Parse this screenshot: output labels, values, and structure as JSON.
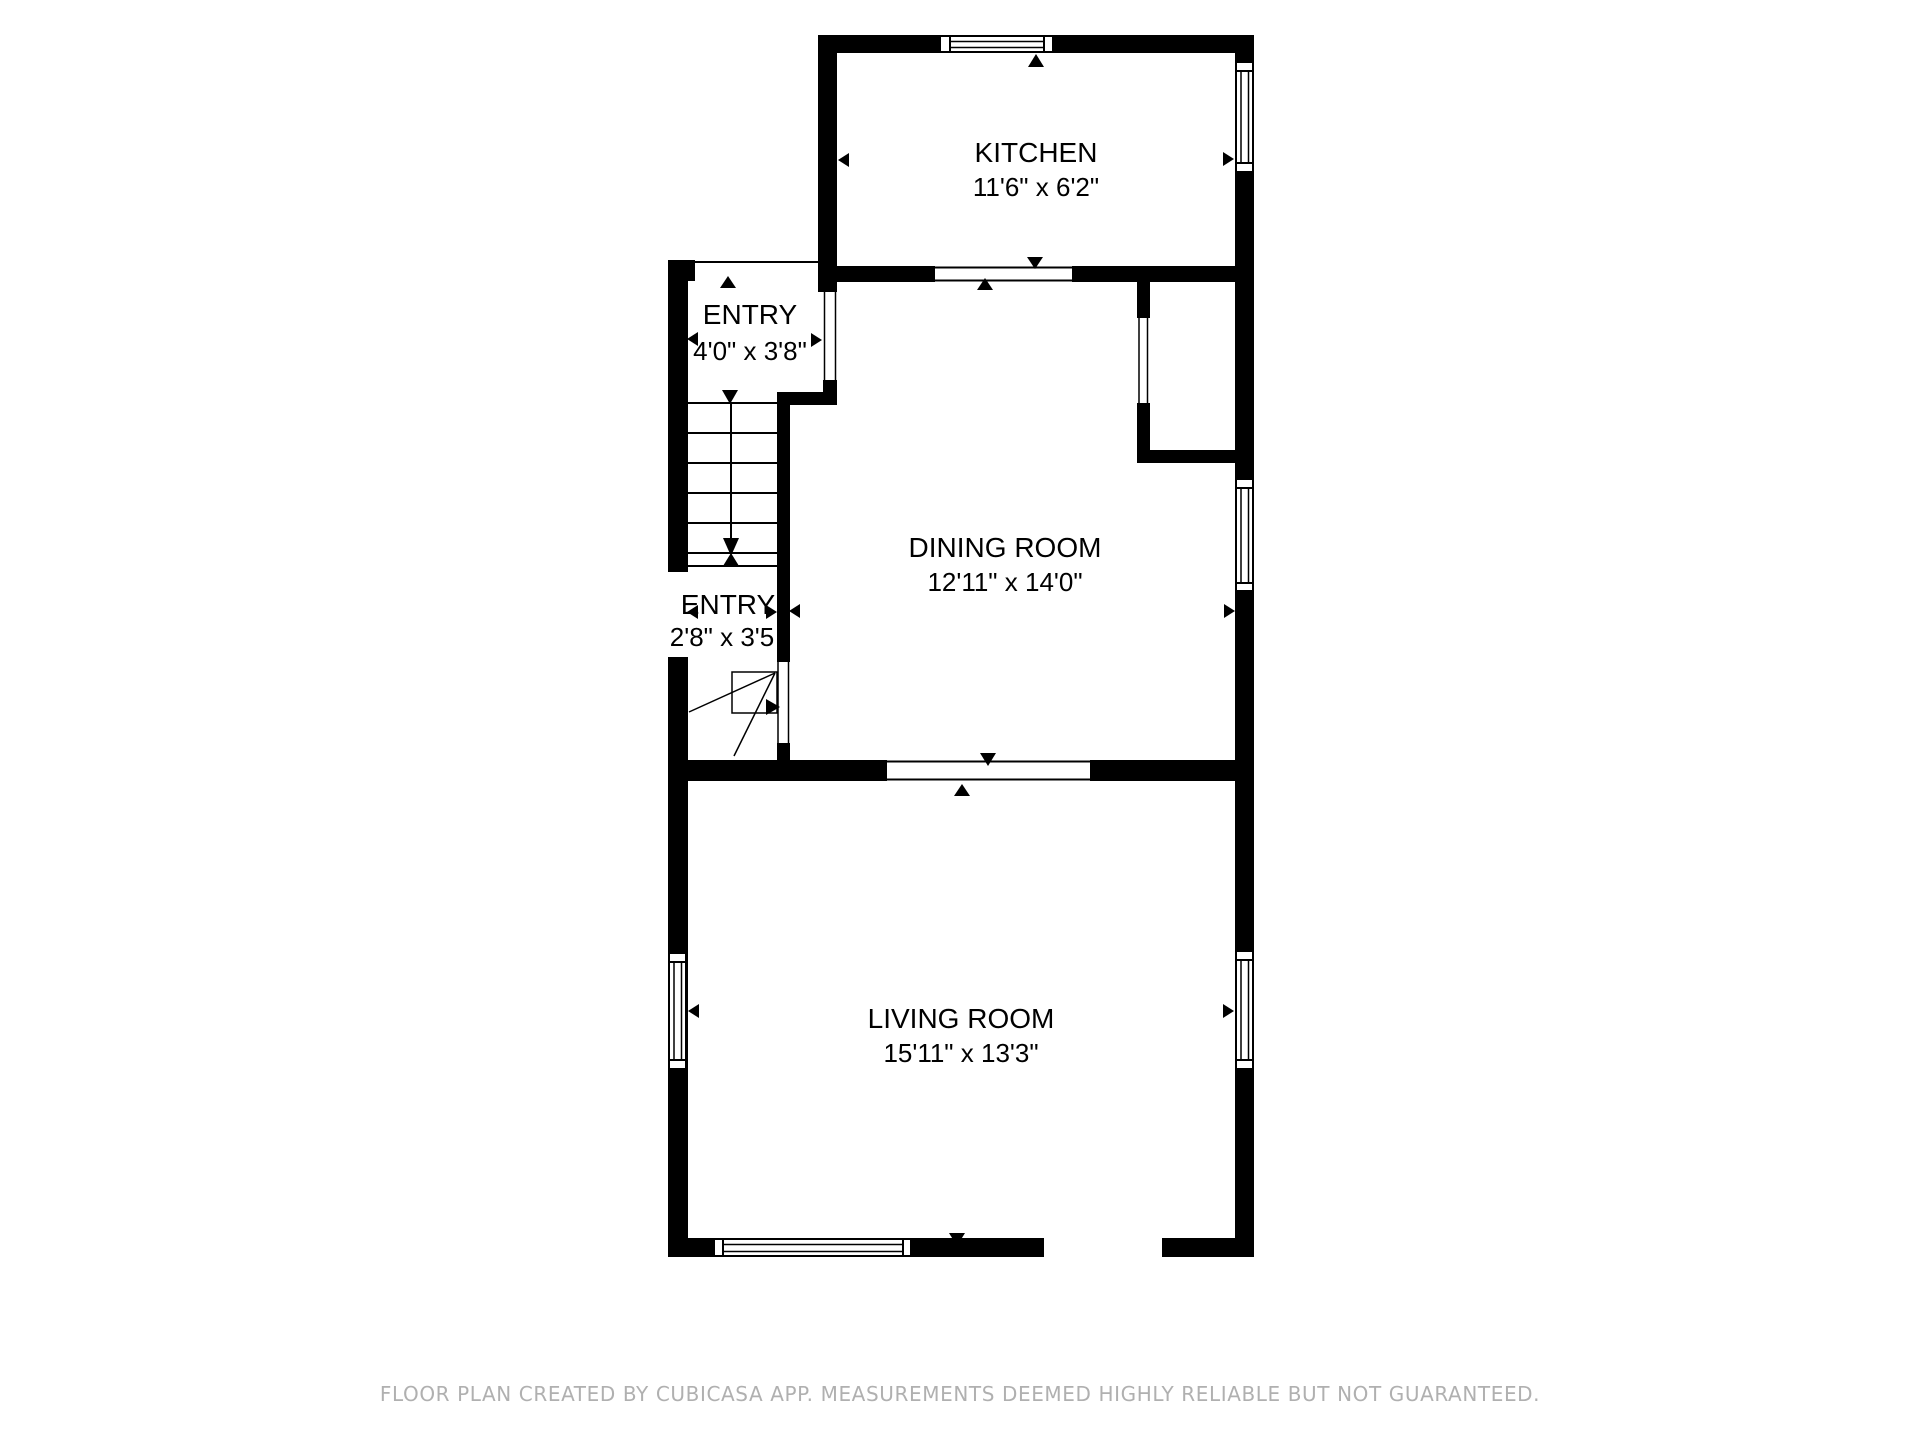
{
  "floor_plan": {
    "rooms": [
      {
        "id": "kitchen",
        "name": "KITCHEN",
        "dimensions": "11'6\" x 6'2\""
      },
      {
        "id": "entry-upper",
        "name": "ENTRY",
        "dimensions": "4'0\" x 3'8\""
      },
      {
        "id": "dining-room",
        "name": "DINING ROOM",
        "dimensions": "12'11\" x 14'0\""
      },
      {
        "id": "entry-lower",
        "name": "ENTRY",
        "dimensions": "2'8\" x 3'5"
      },
      {
        "id": "living-room",
        "name": "LIVING ROOM",
        "dimensions": "15'11\" x 13'3\""
      }
    ],
    "colors": {
      "wall": "#000000",
      "background": "#ffffff",
      "disclaimer_text": "#b0b0b0"
    }
  },
  "footer": {
    "disclaimer": "FLOOR PLAN CREATED BY CUBICASA APP. MEASUREMENTS DEEMED HIGHLY RELIABLE BUT NOT GUARANTEED."
  }
}
